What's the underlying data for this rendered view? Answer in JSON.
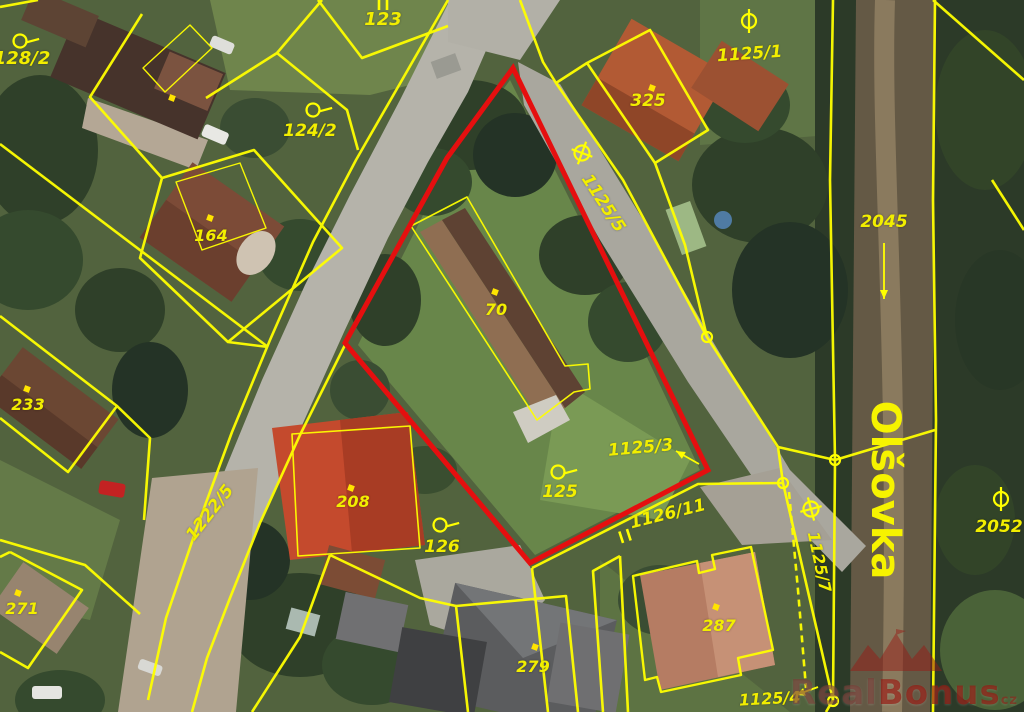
{
  "map": {
    "type": "cadastral-aerial-map",
    "street_name": "Olšovka"
  },
  "colors": {
    "parcel_line": "#ffff00",
    "highlight_outline": "#e50f0f",
    "label": "#f2ee00",
    "dot": "#ffe400"
  },
  "watermark": {
    "part1": "Real",
    "part2": "Bonus",
    "suffix": "cz"
  },
  "labels": [
    {
      "text": "128/2",
      "x": 22,
      "y": 64,
      "rot": 0,
      "size": 18,
      "kind": "parcel"
    },
    {
      "text": "123",
      "x": 383,
      "y": 25,
      "rot": 0,
      "size": 18,
      "kind": "parcel"
    },
    {
      "text": "124/2",
      "x": 310,
      "y": 136,
      "rot": 0,
      "size": 17,
      "kind": "parcel"
    },
    {
      "text": "325",
      "x": 648,
      "y": 106,
      "rot": 0,
      "size": 17,
      "kind": "parcel"
    },
    {
      "text": "1125/1",
      "x": 750,
      "y": 59,
      "rot": -4,
      "size": 17,
      "kind": "parcel"
    },
    {
      "text": "1125/5",
      "x": 599,
      "y": 206,
      "rot": 57,
      "size": 17,
      "kind": "parcel"
    },
    {
      "text": "2045",
      "x": 884,
      "y": 227,
      "rot": 0,
      "size": 17,
      "kind": "parcel"
    },
    {
      "text": "70",
      "x": 496,
      "y": 315,
      "rot": 0,
      "size": 16,
      "kind": "building"
    },
    {
      "text": "164",
      "x": 211,
      "y": 241,
      "rot": 0,
      "size": 16,
      "kind": "building"
    },
    {
      "text": "233",
      "x": 28,
      "y": 410,
      "rot": 0,
      "size": 16,
      "kind": "building"
    },
    {
      "text": "1125/3",
      "x": 641,
      "y": 453,
      "rot": -5,
      "size": 17,
      "kind": "parcel"
    },
    {
      "text": "125",
      "x": 560,
      "y": 497,
      "rot": 0,
      "size": 17,
      "kind": "parcel"
    },
    {
      "text": "208",
      "x": 353,
      "y": 507,
      "rot": 0,
      "size": 16,
      "kind": "building"
    },
    {
      "text": "126",
      "x": 442,
      "y": 552,
      "rot": 0,
      "size": 17,
      "kind": "parcel"
    },
    {
      "text": "1222/5",
      "x": 214,
      "y": 516,
      "rot": -52,
      "size": 17,
      "kind": "parcel"
    },
    {
      "text": "1126/11",
      "x": 669,
      "y": 519,
      "rot": -14,
      "size": 17,
      "kind": "parcel"
    },
    {
      "text": "1125/7",
      "x": 814,
      "y": 563,
      "rot": 78,
      "size": 16,
      "kind": "parcel"
    },
    {
      "text": "2052",
      "x": 999,
      "y": 532,
      "rot": 0,
      "size": 17,
      "kind": "parcel"
    },
    {
      "text": "287",
      "x": 719,
      "y": 631,
      "rot": 0,
      "size": 16,
      "kind": "building"
    },
    {
      "text": "279",
      "x": 533,
      "y": 672,
      "rot": 0,
      "size": 16,
      "kind": "building"
    },
    {
      "text": "271",
      "x": 22,
      "y": 614,
      "rot": 0,
      "size": 16,
      "kind": "building"
    },
    {
      "text": "1125/4",
      "x": 770,
      "y": 704,
      "rot": -3,
      "size": 16,
      "kind": "parcel"
    },
    {
      "text": "Olšovka",
      "x": 872,
      "y": 490,
      "rot": 90,
      "size": 40,
      "kind": "street"
    }
  ],
  "symbols": [
    {
      "type": "circle-tail",
      "x": 20,
      "y": 41,
      "rot": -15,
      "for": "128/2"
    },
    {
      "type": "circle-tail",
      "x": 313,
      "y": 110,
      "rot": -15,
      "for": "124/2"
    },
    {
      "type": "circle-tail",
      "x": 558,
      "y": 472,
      "rot": -15,
      "for": "125"
    },
    {
      "type": "circle-tail",
      "x": 440,
      "y": 525,
      "rot": -15,
      "for": "126"
    },
    {
      "type": "theta",
      "x": 749,
      "y": 21,
      "rot": 0,
      "for": "1125/1"
    },
    {
      "type": "theta",
      "x": 1001,
      "y": 499,
      "rot": 0,
      "for": "2052"
    },
    {
      "type": "oplus",
      "x": 582,
      "y": 153,
      "rot": 20,
      "for": "1125/5"
    },
    {
      "type": "oplus",
      "x": 811,
      "y": 509,
      "rot": -15,
      "for": "1126/11"
    },
    {
      "type": "double-bar",
      "x": 383,
      "y": 4,
      "rot": 0,
      "for": "123"
    },
    {
      "type": "double-bar",
      "x": 625,
      "y": 536,
      "rot": -18,
      "for": "1126/11"
    }
  ],
  "point_markers": [
    [
      172,
      98
    ],
    [
      210,
      218
    ],
    [
      27,
      389
    ],
    [
      495,
      292
    ],
    [
      652,
      88
    ],
    [
      351,
      488
    ],
    [
      535,
      647
    ],
    [
      716,
      607
    ],
    [
      18,
      593
    ]
  ],
  "line_nodes": [
    [
      707,
      337
    ],
    [
      835,
      460
    ],
    [
      783,
      483
    ],
    [
      833,
      701
    ]
  ],
  "arrows": [
    {
      "x1": 884,
      "y1": 243,
      "x2": 884,
      "y2": 299,
      "for": "2045"
    },
    {
      "x1": 699,
      "y1": 464,
      "x2": 676,
      "y2": 451,
      "for": "1125/3"
    },
    {
      "x1": 818,
      "y1": 687,
      "x2": 796,
      "y2": 695,
      "for": "1125/4"
    }
  ]
}
